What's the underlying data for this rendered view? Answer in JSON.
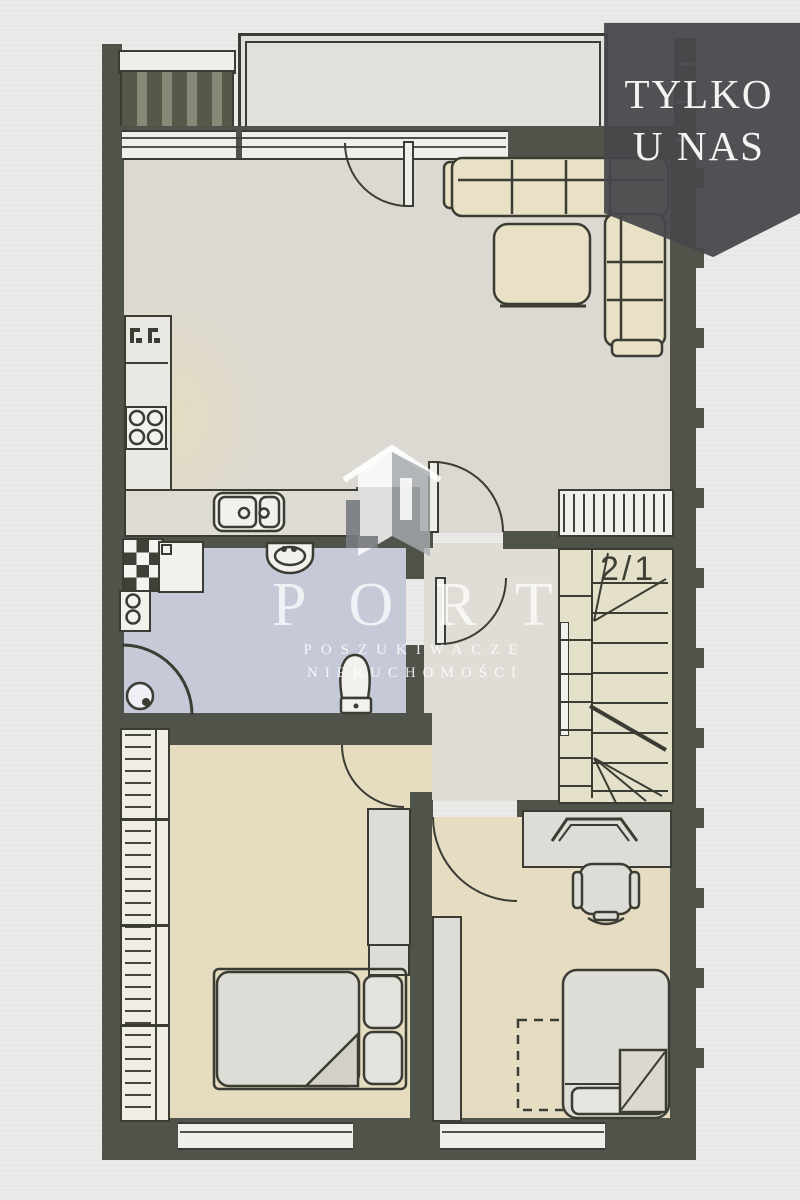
{
  "badge": {
    "line1": "TYLKO",
    "line2": "U NAS",
    "background": "#47474b",
    "text_color": "#f4f3f1"
  },
  "watermark": {
    "brand": "PORT",
    "tagline1": "POSZUKIWACZE",
    "tagline2": "NIERUCHOMOŚCI",
    "color": "#ffffff"
  },
  "floor_plan": {
    "stairs_label": "2/1",
    "colors": {
      "paper": "#eceae8",
      "wall": "#50534a",
      "living_floor": "#dcd9d2",
      "kitchen_tint": "#ebdfb9",
      "bedroom_floor": "#e6ddc0",
      "bedroom2_floor": "#e5dcc1",
      "bathroom_floor": "#c5c9d8",
      "hall_floor": "#dfddd6",
      "stairs_floor": "#e4e0ca",
      "furniture_cream": "#e8e1c5",
      "furniture_gray": "#dedcd6",
      "line": "#3b3c33"
    },
    "fixtures": [
      "corner-sofa",
      "ottoman",
      "kitchen-hob",
      "kitchen-sink",
      "washbasin",
      "toilet",
      "washing-machine",
      "corner-shower",
      "staircase",
      "radiator",
      "double-bed",
      "single-bed",
      "desk",
      "office-chair",
      "wardrobe",
      "balcony",
      "terrace"
    ]
  }
}
